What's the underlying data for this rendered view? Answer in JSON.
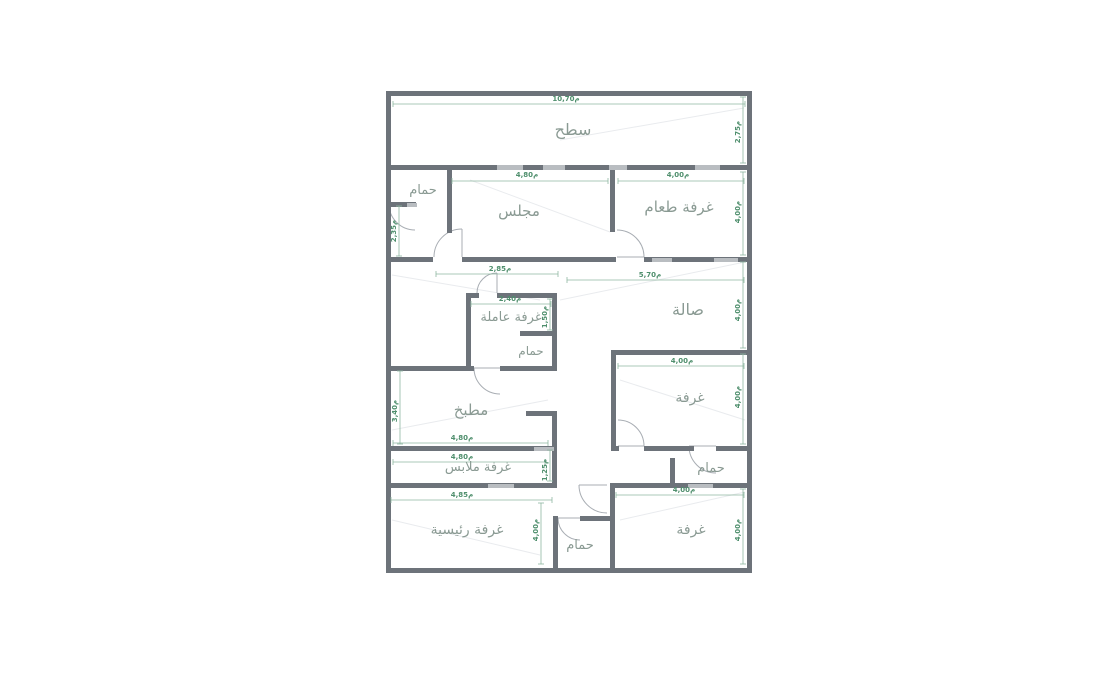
{
  "canvas": {
    "width": 1096,
    "height": 693
  },
  "colors": {
    "background": "#ffffff",
    "wall_dark": "#6d737a",
    "wall_light": "#b9bdc1",
    "dim_green": "#4f8f6d",
    "dim_line": "#8fb7a1",
    "label_gray": "#8a9a93",
    "door_arc": "#a8adb3",
    "faint_line": "#e9ebee"
  },
  "plan": {
    "rooms": [
      {
        "id": "roof-terrace",
        "label": "سطح",
        "x": 573,
        "y": 135,
        "size": 16
      },
      {
        "id": "bathroom-top-left",
        "label": "حمام",
        "x": 423,
        "y": 194,
        "size": 13
      },
      {
        "id": "majlis",
        "label": "مجلس",
        "x": 519,
        "y": 216,
        "size": 15
      },
      {
        "id": "dining-room",
        "label": "غرفة طعام",
        "x": 679,
        "y": 212,
        "size": 15
      },
      {
        "id": "hall",
        "label": "صالة",
        "x": 688,
        "y": 315,
        "size": 16
      },
      {
        "id": "maid-room",
        "label": "غرفة عاملة",
        "x": 511,
        "y": 321,
        "size": 13
      },
      {
        "id": "maid-bathroom",
        "label": "حمام",
        "x": 531,
        "y": 355,
        "size": 12
      },
      {
        "id": "kitchen",
        "label": "مطبخ",
        "x": 471,
        "y": 415,
        "size": 15
      },
      {
        "id": "room-middle-right",
        "label": "غرفة",
        "x": 690,
        "y": 402,
        "size": 14
      },
      {
        "id": "dressing-room",
        "label": "غرفة ملابس",
        "x": 478,
        "y": 471,
        "size": 13
      },
      {
        "id": "bathroom-right",
        "label": "حمام",
        "x": 711,
        "y": 472,
        "size": 13
      },
      {
        "id": "master-bedroom",
        "label": "غرفة رئيسية",
        "x": 467,
        "y": 534,
        "size": 14
      },
      {
        "id": "bathroom-bottom",
        "label": "حمام",
        "x": 580,
        "y": 549,
        "size": 13
      },
      {
        "id": "room-bottom-right",
        "label": "غرفة",
        "x": 691,
        "y": 534,
        "size": 14
      }
    ],
    "dimensions": [
      {
        "id": "dim-top-width",
        "text": "م10,70",
        "x": 566,
        "y": 101,
        "rot": 0,
        "line": [
          393,
          104,
          745,
          104
        ]
      },
      {
        "id": "dim-roof-height",
        "text": "م2,75",
        "x": 740,
        "y": 132,
        "rot": -90,
        "line": [
          743,
          97,
          743,
          163
        ]
      },
      {
        "id": "dim-majlis-width",
        "text": "م4,80",
        "x": 527,
        "y": 177,
        "rot": 0,
        "line": [
          452,
          181,
          608,
          181
        ]
      },
      {
        "id": "dim-dining-width",
        "text": "م4,00",
        "x": 678,
        "y": 177,
        "rot": 0,
        "line": [
          618,
          181,
          744,
          181
        ]
      },
      {
        "id": "dim-dining-height",
        "text": "م4,00",
        "x": 740,
        "y": 212,
        "rot": -90,
        "line": [
          743,
          172,
          743,
          255
        ]
      },
      {
        "id": "dim-bath-tl-height",
        "text": "م2,35",
        "x": 396,
        "y": 231,
        "rot": -90,
        "line": [
          399,
          206,
          399,
          256
        ]
      },
      {
        "id": "dim-hall-west",
        "text": "م2,85",
        "x": 500,
        "y": 271,
        "rot": 0,
        "line": [
          436,
          274,
          558,
          274
        ]
      },
      {
        "id": "dim-hall-width",
        "text": "م5,70",
        "x": 650,
        "y": 277,
        "rot": 0,
        "line": [
          567,
          280,
          744,
          280
        ]
      },
      {
        "id": "dim-hall-height",
        "text": "م4,00",
        "x": 740,
        "y": 310,
        "rot": -90,
        "line": [
          743,
          262,
          743,
          348
        ]
      },
      {
        "id": "dim-maid-width",
        "text": "م2,40",
        "x": 510,
        "y": 301,
        "rot": 0,
        "line": [
          471,
          304,
          551,
          304
        ]
      },
      {
        "id": "dim-maid-height",
        "text": "م1,50",
        "x": 547,
        "y": 317,
        "rot": -90,
        "line": [
          550,
          299,
          550,
          330
        ]
      },
      {
        "id": "dim-room-mid-width",
        "text": "م4,00",
        "x": 682,
        "y": 363,
        "rot": 0,
        "line": [
          618,
          366,
          744,
          366
        ]
      },
      {
        "id": "dim-room-mid-height",
        "text": "م4,00",
        "x": 740,
        "y": 397,
        "rot": -90,
        "line": [
          743,
          354,
          743,
          444
        ]
      },
      {
        "id": "dim-kitchen-height",
        "text": "م3,40",
        "x": 397,
        "y": 411,
        "rot": -90,
        "line": [
          400,
          371,
          400,
          444
        ]
      },
      {
        "id": "dim-kitchen-width",
        "text": "م4,80",
        "x": 462,
        "y": 440,
        "rot": 0,
        "line": [
          393,
          443,
          548,
          443
        ]
      },
      {
        "id": "dim-dressing-width",
        "text": "م4,80",
        "x": 462,
        "y": 459,
        "rot": 0,
        "line": [
          393,
          462,
          545,
          462
        ]
      },
      {
        "id": "dim-dressing-height",
        "text": "م1,25",
        "x": 547,
        "y": 470,
        "rot": -90,
        "line": [
          550,
          450,
          550,
          481
        ]
      },
      {
        "id": "dim-master-width",
        "text": "م4,85",
        "x": 462,
        "y": 497,
        "rot": 0,
        "line": [
          391,
          500,
          552,
          500
        ]
      },
      {
        "id": "dim-master-height",
        "text": "م4,00",
        "x": 538,
        "y": 530,
        "rot": -90,
        "line": [
          541,
          503,
          541,
          564
        ]
      },
      {
        "id": "dim-room-br-width",
        "text": "م4,00",
        "x": 684,
        "y": 492,
        "rot": 0,
        "line": [
          616,
          495,
          744,
          495
        ]
      },
      {
        "id": "dim-room-br-height",
        "text": "م4,00",
        "x": 740,
        "y": 530,
        "rot": -90,
        "line": [
          743,
          489,
          743,
          564
        ]
      }
    ],
    "walls_dark": [
      [
        386,
        91,
        366,
        5
      ],
      [
        386,
        568,
        366,
        5
      ],
      [
        386,
        91,
        5,
        482
      ],
      [
        747,
        91,
        5,
        482
      ],
      [
        391,
        165,
        356,
        5
      ],
      [
        447,
        170,
        5,
        63
      ],
      [
        391,
        202,
        25,
        5
      ],
      [
        391,
        257,
        42,
        5
      ],
      [
        462,
        257,
        154,
        5
      ],
      [
        644,
        257,
        103,
        5
      ],
      [
        610,
        170,
        5,
        62
      ],
      [
        466,
        293,
        13,
        5
      ],
      [
        497,
        293,
        60,
        5
      ],
      [
        466,
        293,
        5,
        77
      ],
      [
        552,
        293,
        5,
        77
      ],
      [
        520,
        331,
        37,
        5
      ],
      [
        500,
        366,
        57,
        5
      ],
      [
        386,
        366,
        88,
        5
      ],
      [
        611,
        350,
        5,
        100
      ],
      [
        611,
        350,
        136,
        5
      ],
      [
        611,
        446,
        8,
        5
      ],
      [
        644,
        446,
        50,
        5
      ],
      [
        716,
        446,
        31,
        5
      ],
      [
        670,
        458,
        5,
        27
      ],
      [
        610,
        483,
        137,
        5
      ],
      [
        386,
        483,
        171,
        5
      ],
      [
        386,
        446,
        171,
        5
      ],
      [
        526,
        411,
        31,
        5
      ],
      [
        552,
        411,
        5,
        76
      ],
      [
        610,
        483,
        5,
        90
      ],
      [
        553,
        516,
        5,
        57
      ],
      [
        580,
        516,
        32,
        5
      ]
    ],
    "walls_light": [
      [
        497,
        165,
        26,
        5
      ],
      [
        543,
        165,
        22,
        5
      ],
      [
        609,
        165,
        18,
        5
      ],
      [
        695,
        165,
        25,
        5
      ],
      [
        652,
        258,
        20,
        4
      ],
      [
        714,
        258,
        24,
        4
      ],
      [
        688,
        484,
        25,
        4
      ],
      [
        488,
        484,
        26,
        4
      ],
      [
        534,
        447,
        20,
        4
      ],
      [
        407,
        203,
        10,
        4
      ]
    ],
    "doors": [
      {
        "id": "door-bathroom-top-left",
        "cx": 415,
        "cy": 204,
        "r": 26,
        "a1": 90,
        "a2": 180
      },
      {
        "id": "door-majlis",
        "cx": 462,
        "cy": 257,
        "r": 28,
        "a1": 180,
        "a2": 270
      },
      {
        "id": "door-dining",
        "cx": 617,
        "cy": 257,
        "r": 27,
        "a1": 270,
        "a2": 360
      },
      {
        "id": "door-maid-room",
        "cx": 497,
        "cy": 293,
        "r": 20,
        "a1": 180,
        "a2": 270
      },
      {
        "id": "door-kitchen",
        "cx": 500,
        "cy": 368,
        "r": 26,
        "a1": 90,
        "a2": 180
      },
      {
        "id": "door-room-middle",
        "cx": 618,
        "cy": 446,
        "r": 26,
        "a1": 270,
        "a2": 360
      },
      {
        "id": "door-bathroom-right",
        "cx": 716,
        "cy": 446,
        "r": 27,
        "a1": 90,
        "a2": 180
      },
      {
        "id": "door-corridor",
        "cx": 607,
        "cy": 485,
        "r": 28,
        "a1": 90,
        "a2": 180
      },
      {
        "id": "door-bathroom-bottom",
        "cx": 580,
        "cy": 518,
        "r": 22,
        "a1": 90,
        "a2": 180
      }
    ],
    "faint_lines": [
      [
        392,
        275,
        540,
        300
      ],
      [
        560,
        300,
        745,
        262
      ],
      [
        470,
        180,
        610,
        232
      ],
      [
        392,
        430,
        548,
        400
      ],
      [
        620,
        380,
        745,
        420
      ],
      [
        620,
        520,
        745,
        492
      ],
      [
        392,
        520,
        540,
        555
      ],
      [
        560,
        140,
        744,
        108
      ]
    ]
  }
}
